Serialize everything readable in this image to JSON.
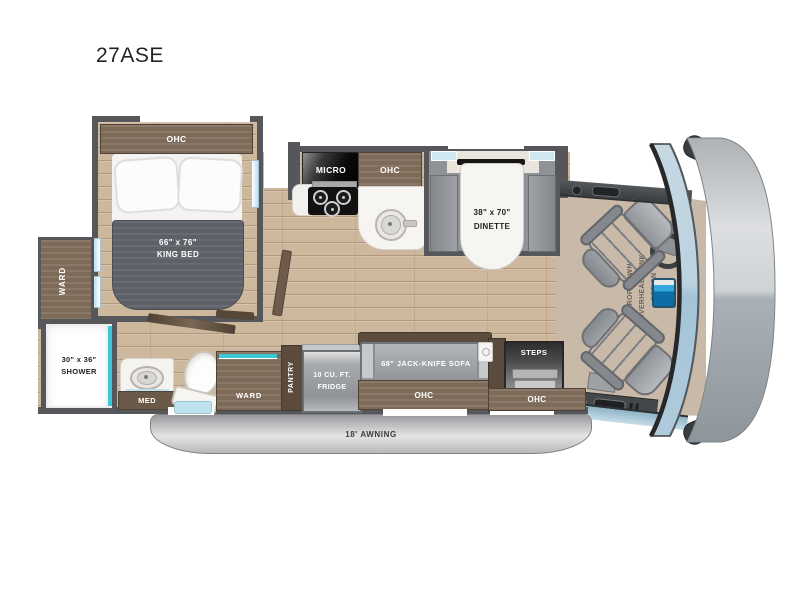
{
  "title": "27ASE",
  "floorplan": {
    "bedroom": {
      "ohc": "OHC",
      "bed_size": "66\" x 76\"",
      "bed_name": "KING BED",
      "ward": "WARD"
    },
    "bath": {
      "shower_size": "30\" x 36\"",
      "shower_name": "SHOWER",
      "med": "MED"
    },
    "kitchen": {
      "micro": "MICRO",
      "ohc": "OHC",
      "pantry": "PANTRY",
      "fridge_line1": "10 CU. FT.",
      "fridge_line2": "FRIDGE"
    },
    "living": {
      "tv": "39\" TV",
      "dinette_size": "38\" x 70\"",
      "dinette_name": "DINETTE",
      "hall_ward": "WARD",
      "sofa": "68\" JACK-KNIFE SOFA",
      "sofa_ohc": "OHC"
    },
    "entry": {
      "steps": "STEPS",
      "ohc": "OHC"
    },
    "cab": {
      "bunk_line1": "DROP-DOWN",
      "bunk_line2": "OVERHEAD BUNK",
      "bunk_line3": "OPTION"
    },
    "exterior": {
      "awning": "18' AWNING"
    }
  },
  "colors": {
    "wall": "#55575a",
    "wood": "#cdb89e",
    "cabinet": "#7d6a58",
    "cabinet_dark": "#5a4b3d",
    "teal": "#3cc7d4",
    "window_blue": "#cfe7f0",
    "blanket": "#5d6067",
    "bench": "#8f9296",
    "seat": "#a6a9ae",
    "table_white": "#f6f5f2",
    "windshield": "#b7d0de",
    "front_cap": "#c9ccce",
    "awning_gray": "#c6c7c9",
    "appliance_black": "#111111",
    "fridge_gray": "#9fa2a5",
    "mat_blue": "#bfe3ee"
  }
}
